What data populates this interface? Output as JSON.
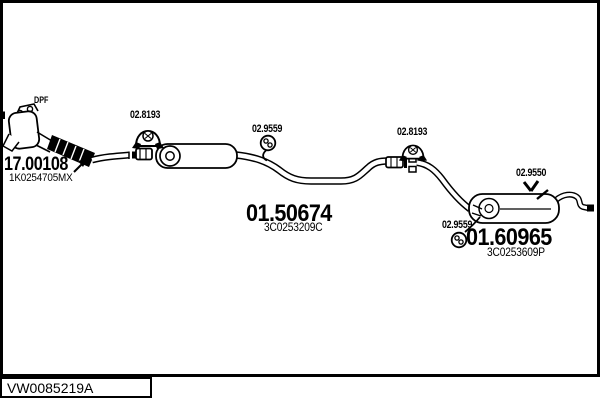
{
  "colors": {
    "ink": "#000000",
    "paper": "#ffffff"
  },
  "parts": {
    "dpf_tag": "DPF",
    "front_pipe": {
      "number": "17.00108",
      "oem": "1K0254705MX"
    },
    "mid_muffler": {
      "number": "01.50674",
      "oem": "3C0253209C"
    },
    "rear_muffler": {
      "number": "01.60965",
      "oem": "3C0253609P"
    },
    "clamp_front": {
      "number": "02.8193"
    },
    "clamp_rear": {
      "number": "02.8193"
    },
    "hanger_mid": {
      "number": "02.9559"
    },
    "hanger_rear": {
      "number": "02.9559"
    },
    "hanger_top": {
      "number": "02.9550"
    }
  },
  "footer": {
    "catalog_code": "VW0085219A"
  }
}
